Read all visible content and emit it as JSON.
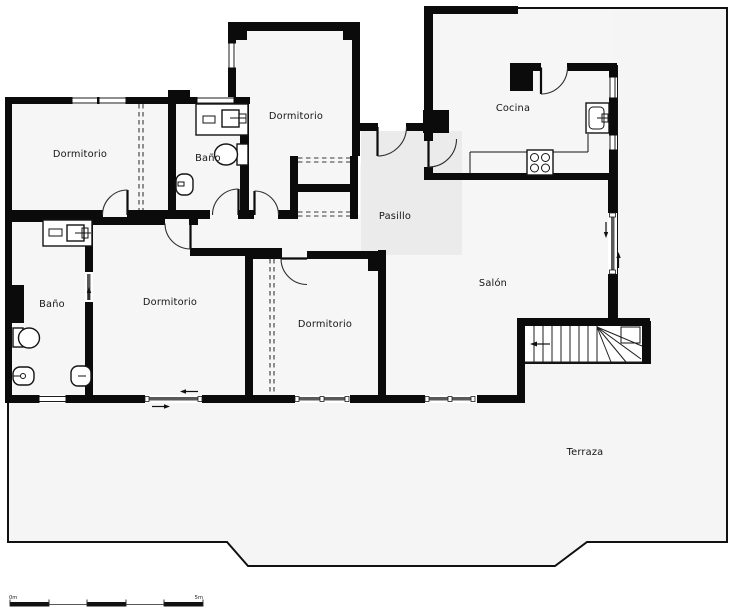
{
  "plan": {
    "type": "floor-plan",
    "rooms": {
      "dormitorio_nw": {
        "label": "Dormitorio"
      },
      "bano_top": {
        "label": "Baño"
      },
      "dormitorio_n": {
        "label": "Dormitorio"
      },
      "cocina": {
        "label": "Cocina"
      },
      "pasillo": {
        "label": "Pasillo"
      },
      "salon": {
        "label": "Salón"
      },
      "bano_w": {
        "label": "Baño"
      },
      "dormitorio_sw": {
        "label": "Dormitorio"
      },
      "dormitorio_s": {
        "label": "Dormitorio"
      },
      "terraza": {
        "label": "Terraza"
      }
    },
    "scale_bar": {
      "start_label": "0m",
      "end_label": "5m"
    },
    "colors": {
      "wall": "#0b0b0b",
      "room_fill": "#f6f6f6",
      "terrace_fill": "#f5f5f5",
      "hallway_highlight": "#ebebeb",
      "background": "#ffffff"
    }
  }
}
